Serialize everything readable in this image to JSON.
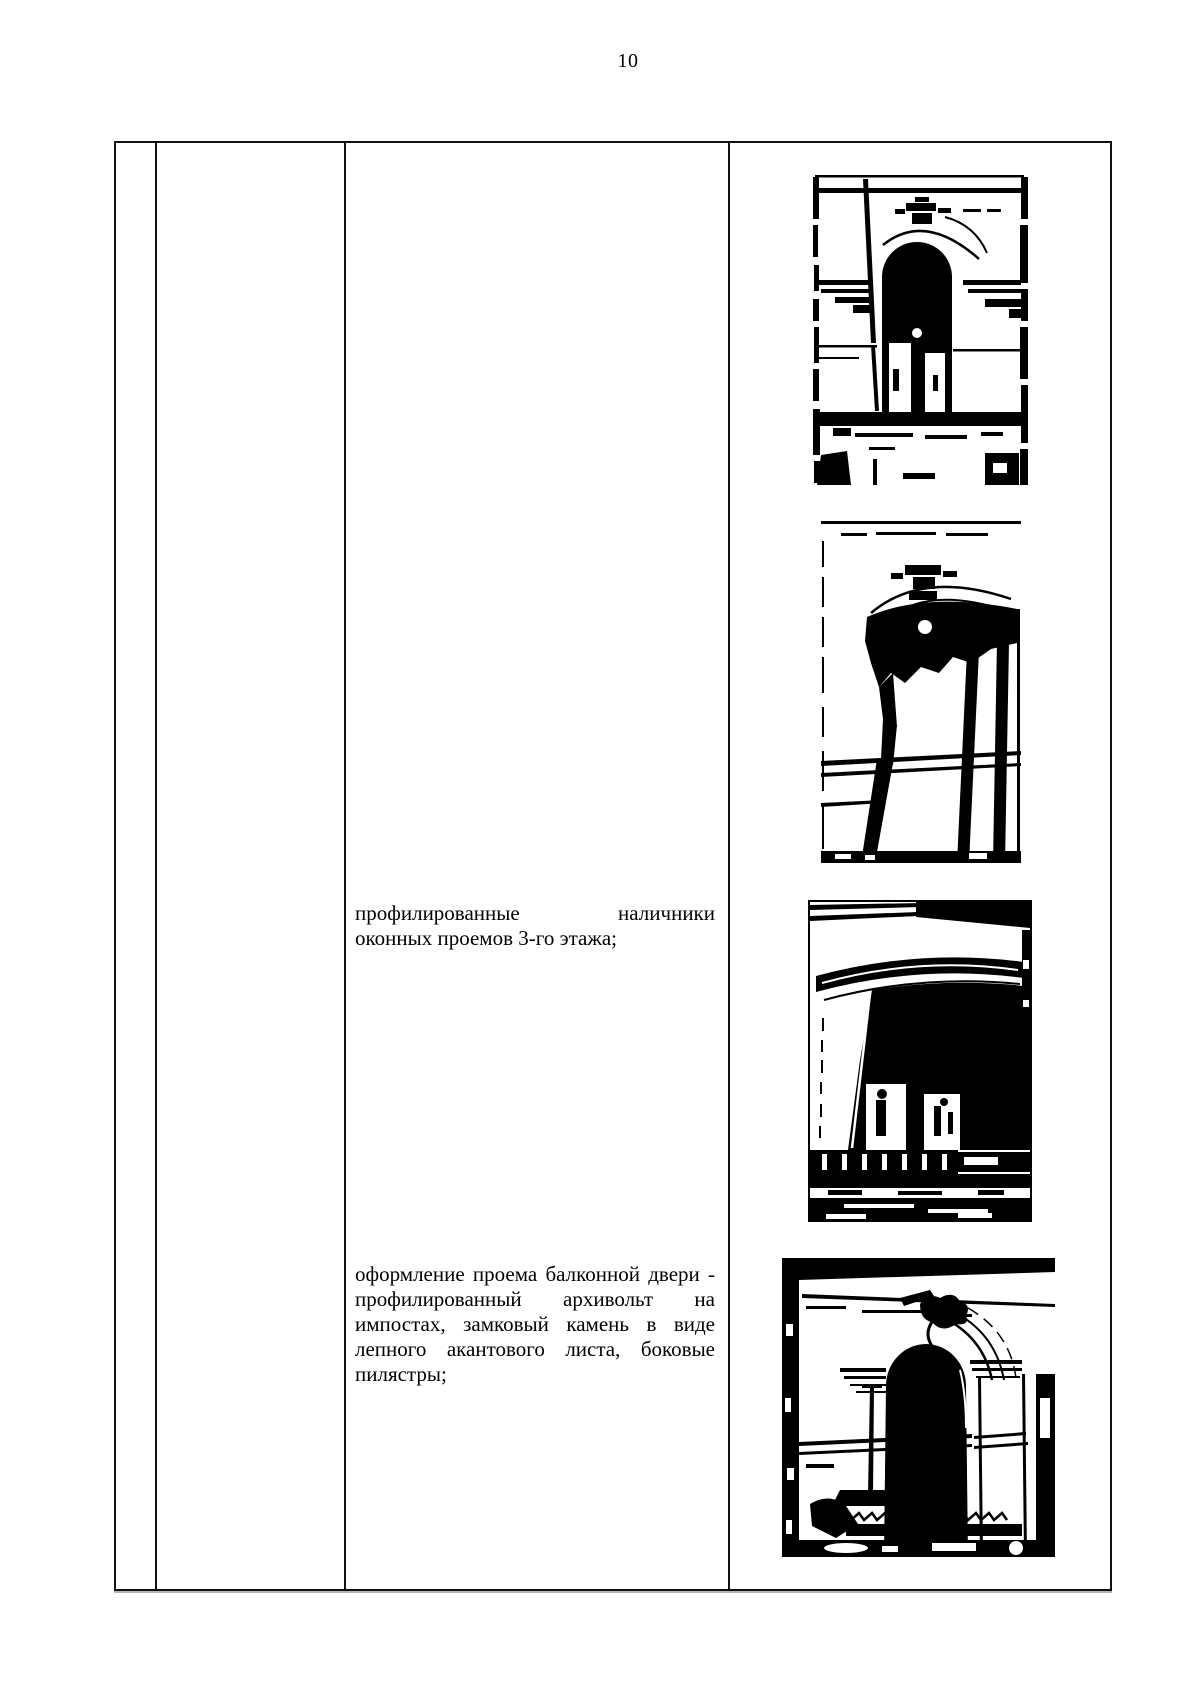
{
  "page": {
    "number": "10"
  },
  "colors": {
    "ink": "#000000",
    "paper": "#ffffff"
  },
  "table": {
    "paragraphs": [
      {
        "name": "window-casings-paragraph",
        "lines": [
          "профилированные наличники",
          "оконных проемов 3-го этажа;"
        ]
      },
      {
        "name": "balcony-door-paragraph",
        "lines": [
          "оформление проема балконной двери -",
          "профилированный архивольт на",
          "импостах, замковый камень в виде",
          "лепного акантового листа, боковые",
          "пилястры;"
        ]
      }
    ],
    "photos": [
      {
        "name": "arched-window-niche-photo"
      },
      {
        "name": "segmental-arch-window-photo"
      },
      {
        "name": "profiled-window-surround-photo"
      },
      {
        "name": "balcony-door-archivolt-photo"
      }
    ]
  }
}
